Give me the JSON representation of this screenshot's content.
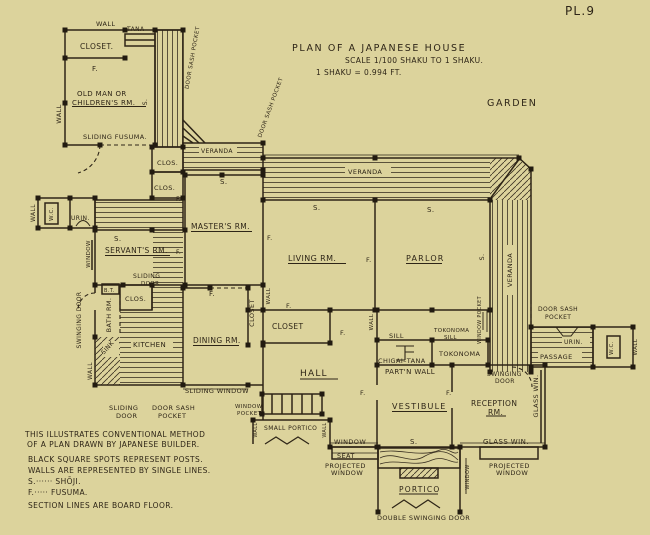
{
  "page": {
    "plate_no": "PL.9",
    "title": "PLAN OF A JAPANESE HOUSE",
    "scale_line1": "SCALE   1/100 SHAKU TO 1 SHAKU.",
    "scale_line2": "1 SHAKU = 0.994 FT.",
    "garden": "GARDEN"
  },
  "notes": [
    "THIS ILLUSTRATES CONVENTIONAL METHOD",
    "OF A PLAN DRAWN BY JAPANESE BUILDER.",
    "BLACK SQUARE SPOTS REPRESENT POSTS.",
    "WALLS ARE REPRESENTED BY SINGLE LINES.",
    "S.······ SHŌJI.",
    "F.····· FUSUMA.",
    "SECTION LINES ARE BOARD FLOOR."
  ],
  "colors": {
    "paper": "#dcd39c",
    "ink": "#2e2517"
  },
  "labels": {
    "wallTop": "WALL",
    "closetTop": "CLOSET.",
    "tana": "TANA",
    "dspTL": "DOOR SASH POCKET",
    "fClosetTop": "F.",
    "oldman1": "OLD MAN OR",
    "oldman2": "CHILDREN'S RM.",
    "sVert1": "S.",
    "wallLeftTop": "WALL",
    "slidingFusuma": "SLIDING FUSUMA.",
    "verandaTL": "VERANDA",
    "dspDiag": "DOOR SASH POCKET",
    "clos1": "CLOS.",
    "clos2": "CLOS.",
    "s1": "S.",
    "verandaTop": "VERANDA",
    "s2": "S.",
    "s3": "S.",
    "masters": "MASTER'S RM.",
    "living": "LIVING RM.",
    "parlor": "PARLOR",
    "fM1": "F.",
    "fM2": "F.",
    "fM3": "F.",
    "fM4": "F.",
    "s4": "S.",
    "verandaRight": "VERANDA",
    "wallWC": "WALL",
    "wcLeft": "W.C.",
    "urinLeft": "URIN.",
    "s5": "S.",
    "servants": "SERVANT'S RM.",
    "windowLeft": "WINDOW",
    "sliding1a": "SLIDING",
    "sliding1b": "DOOR",
    "bt": "B.T.",
    "clos3": "CLOS.",
    "swingDoorL": "SWINGING DOOR",
    "bathRm": "BATH RM.",
    "sink": "SINK",
    "wallKitchen": "WALL",
    "kitchen": "KITCHEN",
    "dining": "DINING RM.",
    "closetVert": "CLOSET",
    "wallVert1": "WALL",
    "fDining": "F.",
    "fCl1": "F.",
    "slidingWindow": "SLIDING WINDOW",
    "sliding2a": "SLIDING",
    "sliding2b": "DOOR",
    "dsp2a": "DOOR SASH",
    "dsp2b": "POCKET",
    "winPocket1a": "WINDOW",
    "winPocket1b": "POCKET",
    "closetMid": "CLOSET",
    "fCl2": "F.",
    "hall": "HALL",
    "wallVert2": "WALL",
    "sill": "SILL",
    "tokSill1": "TOKONOMA",
    "tokSill2": "SILL",
    "winPocket2": "WINDOW POCKET",
    "tokonoma": "TOKONOMA",
    "chigai": "CHIGAI–TANA",
    "partn": "PART'N WALL",
    "vestibule": "VESTIBULE",
    "reception1": "RECEPTION",
    "reception2": "RM.",
    "swing2a": "SWINGING",
    "swing2b": "DOOR",
    "glassWinV": "GLASS WIN.",
    "fV1": "F.",
    "fV2": "F.",
    "smallPortico": "SMALL PORTICO",
    "wallVert3": "WALL",
    "wallVert4": "WALL",
    "windowB": "WINDOW",
    "seat": "SEAT",
    "s6": "S.",
    "glassWinB": "GLASS WIN.",
    "projWin1a": "PROJECTED",
    "projWin1b": "WINDOW",
    "projWin2a": "PROJECTED",
    "projWin2b": "WINDOW",
    "portico": "PORTICO",
    "windowVertP": "WINDOW",
    "dblSwing": "DOUBLE SWINGING DOOR",
    "dsp3a": "DOOR SASH",
    "dsp3b": "POCKET",
    "urinR": "URIN.",
    "passage": "PASSAGE",
    "wcRight": "W.C.",
    "wallRight": "WALL"
  }
}
